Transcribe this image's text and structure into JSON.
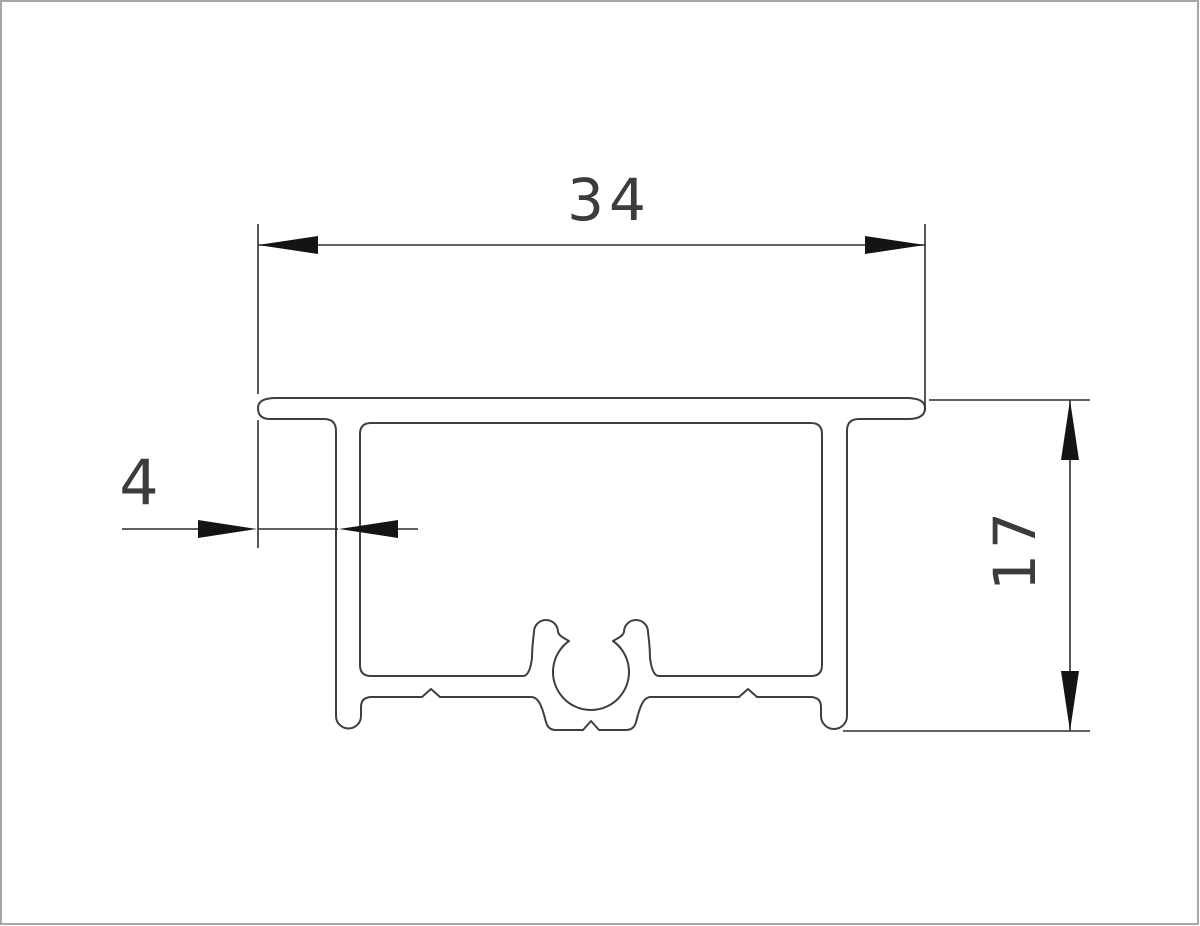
{
  "drawing": {
    "type": "profile-cross-section-technical-drawing",
    "dimensions": {
      "width": {
        "value": "34"
      },
      "wall": {
        "value": "4"
      },
      "height": {
        "value": "17"
      }
    }
  },
  "colors": {
    "background": "#ffffff",
    "outline": "#3f3f3f",
    "dimension_line": "#2f2f2f",
    "arrow": "#141414",
    "text": "#3c3c3c",
    "border": "#a6a6a6"
  }
}
